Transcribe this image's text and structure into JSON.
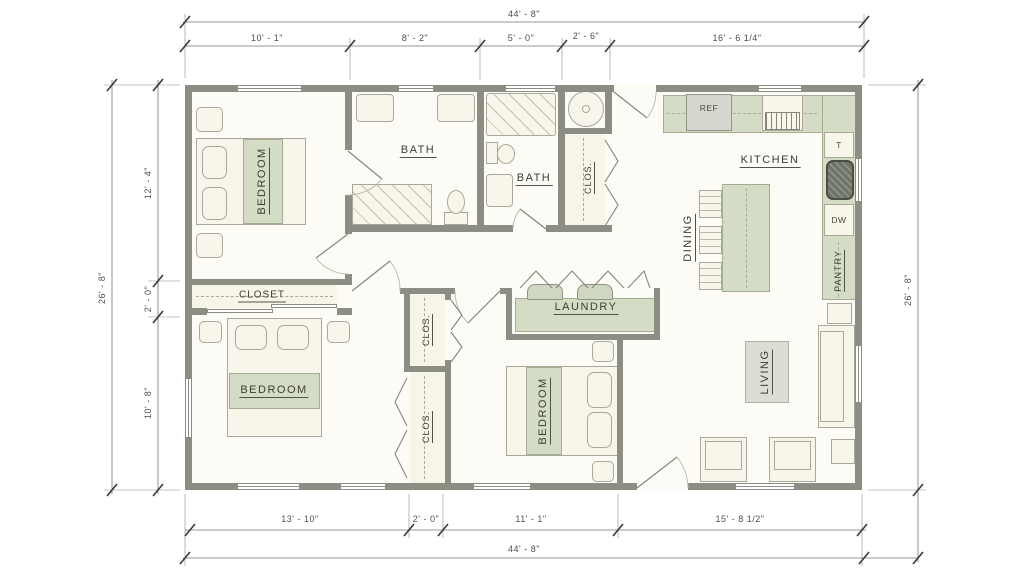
{
  "dimensions": {
    "top_total": "44' - 8\"",
    "top_segments": [
      "10' - 1\"",
      "8' - 2\"",
      "5' - 0\"",
      "2' - 6\"",
      "16' - 6 1/4\""
    ],
    "left_total": "26' - 8\"",
    "left_segments": [
      "12' - 4\"",
      "2' - 0\"",
      "10' - 8\""
    ],
    "right_total": "26' - 8\"",
    "bottom_total": "44' - 8\"",
    "bottom_segments": [
      "13' - 10\"",
      "2' - 0\"",
      "11' - 1\"",
      "15' - 8 1/2\""
    ]
  },
  "rooms": {
    "bedroom_top": "BEDROOM",
    "bedroom_master": "BEDROOM",
    "bedroom_third": "BEDROOM",
    "bath_top": "BATH",
    "bath_hall": "BATH",
    "closet_master": "CLOSET",
    "closet_hall": "CLOS.",
    "closet_upper": "CLOS.",
    "closet_lower": "CLOS.",
    "kitchen": "KITCHEN",
    "dining": "DINING",
    "pantry": "PANTRY",
    "laundry": "LAUNDRY",
    "living": "LIVING"
  },
  "appliances": {
    "ref": "REF",
    "dw": "DW",
    "t": "T"
  },
  "colors": {
    "wall": "#8c8d83",
    "cabinet_green": "#d5dcc6",
    "floor": "#fcfbf5",
    "furniture": "#f8f6ea"
  }
}
